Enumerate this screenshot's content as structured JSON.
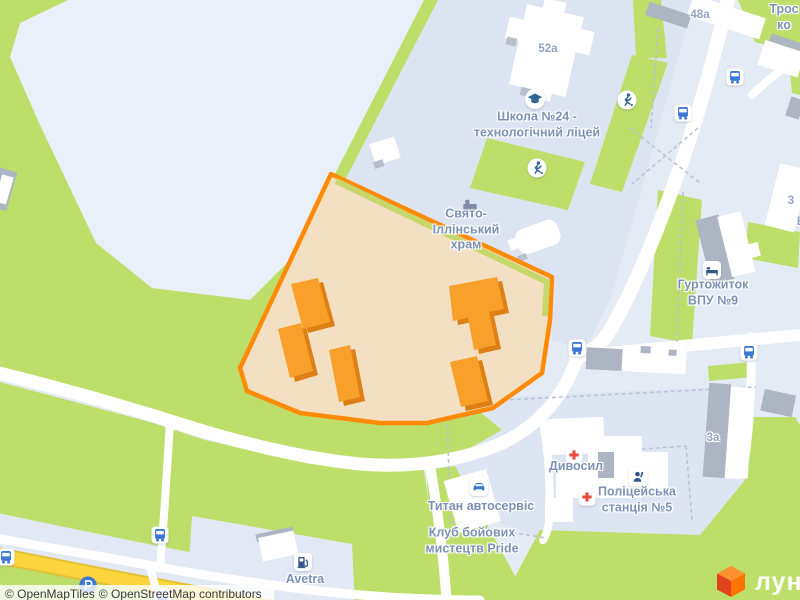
{
  "map": {
    "attribution": {
      "openmaptiles": "© OpenMapTiles",
      "osm": "© OpenStreetMap contributors"
    },
    "brand": {
      "logo_text": "лун"
    },
    "colors": {
      "site_outline": "#ff8a05",
      "site_fill": "#f3e0c3",
      "site_building": "#f9a02a",
      "site_building_side": "#dd7f15",
      "park_green": "#bede6a",
      "road_yellow": "#fcd43c",
      "label_blue_gray": "#7e91b4",
      "icon_blue": "#3b78d4",
      "medical_red": "#e84a3f",
      "logo_orange": "#ff7300"
    }
  },
  "pois": {
    "school": {
      "label": "Школа №24 -\nтехнологічний ліцей",
      "icon": "graduation-cap"
    },
    "church": {
      "label": "Свято-\nІллінський\nхрам",
      "icon": "church-building"
    },
    "dormitory": {
      "label": "Гуртожиток\nВПУ №9",
      "icon": "bed"
    },
    "pharmacy": {
      "label": "Дивосил",
      "icon": "medical-cross"
    },
    "police_station": {
      "label": "Поліцейська\nстанція №5",
      "icon": "police-officer"
    },
    "auto_service": {
      "label": "Титан автосервіс",
      "icon": "car"
    },
    "martial_arts_club": {
      "label": "Клуб бойових\nмистецтв Pride"
    },
    "fuel_station": {
      "label": "Avetra",
      "icon": "fuel-pump"
    }
  },
  "street_labels": {
    "top_right_fragment": "Трос\nко"
  },
  "house_numbers": {
    "h52a": "52a",
    "h48a": "48a",
    "h3": "3",
    "hB": "В",
    "h3a": "3а"
  }
}
